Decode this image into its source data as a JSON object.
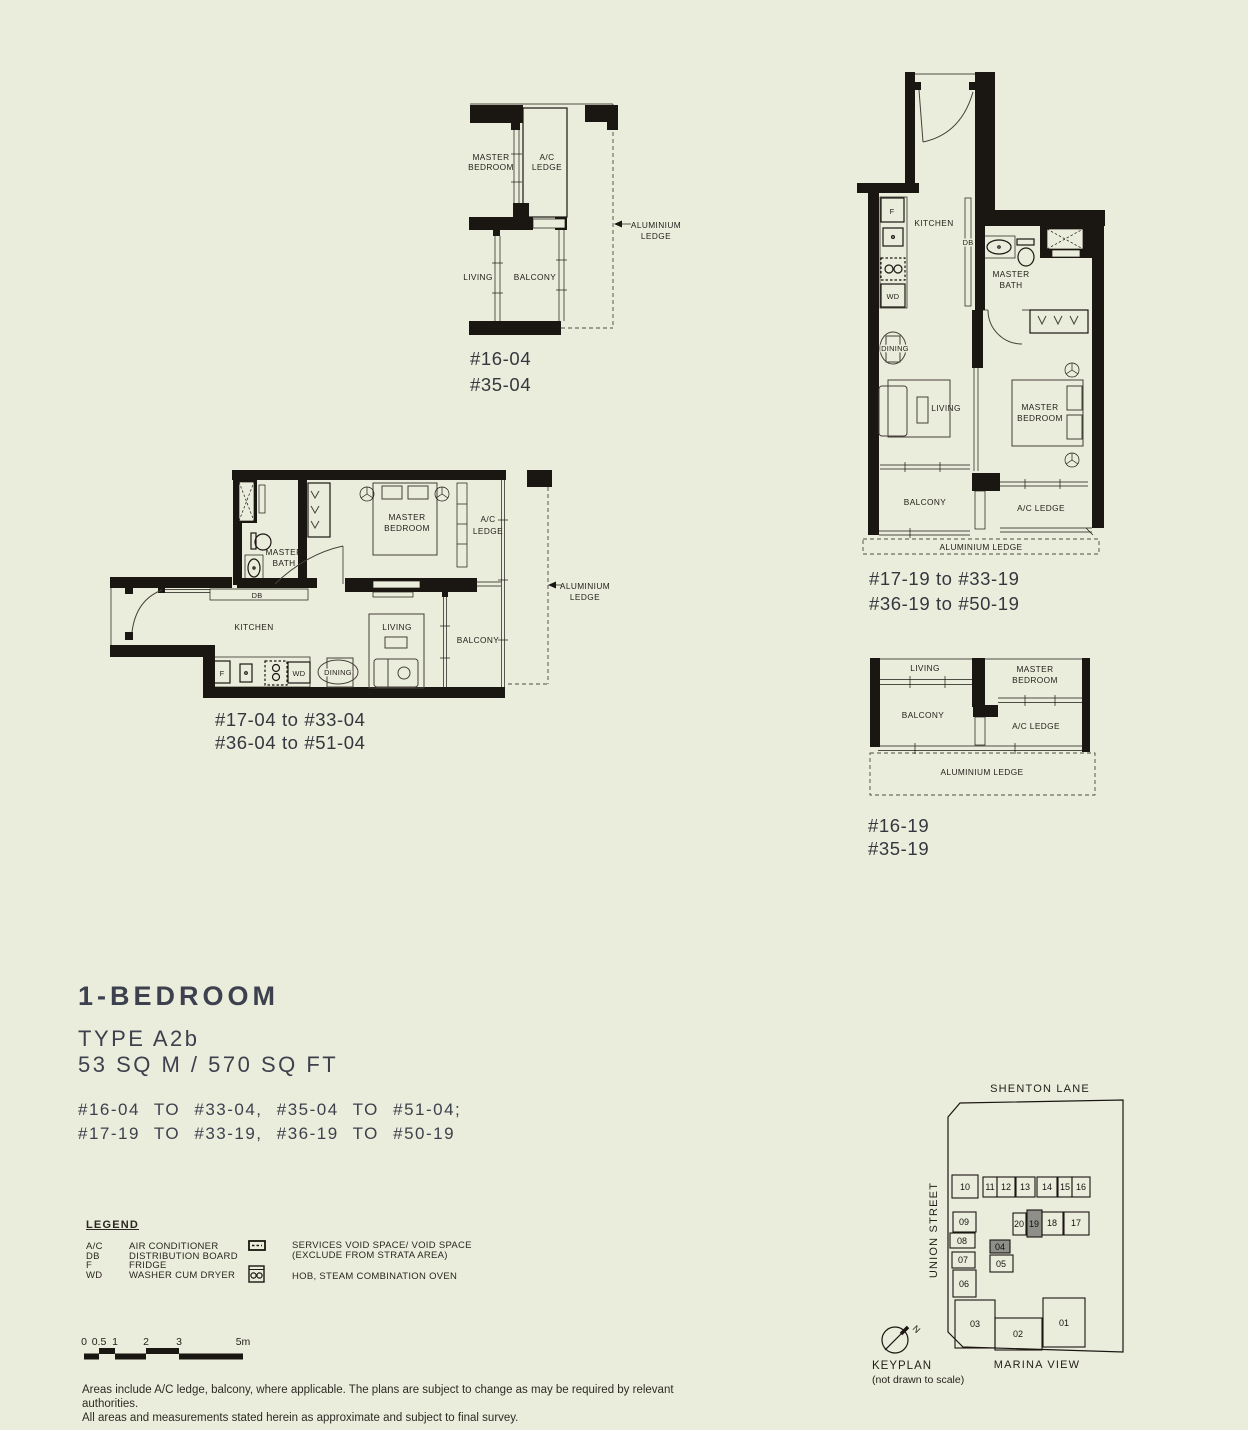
{
  "page": {
    "background": "#ebeddc",
    "ink": "#1a1611",
    "accent_text": "#3d414e"
  },
  "rooms": {
    "master": "MASTER",
    "bedroom": "BEDROOM",
    "bath": "BATH",
    "ac": "A/C",
    "ledge": "LEDGE",
    "ac_ledge": "A/C LEDGE",
    "living": "LIVING",
    "balcony": "BALCONY",
    "kitchen": "KITCHEN",
    "dining": "DINING",
    "db": "DB",
    "f": "F",
    "wd": "WD",
    "aluminium": "ALUMINIUM",
    "aluminium_ledge": "ALUMINIUM LEDGE"
  },
  "plans": {
    "top_left": {
      "units1": "#16-04",
      "units2": "#35-04"
    },
    "top_right": {
      "units1": "#17-19 to #33-19",
      "units2": "#36-19 to #50-19"
    },
    "mid_left": {
      "units1": "#17-04 to #33-04",
      "units2": "#36-04 to #51-04"
    },
    "right_partial": {
      "units1": "#16-19",
      "units2": "#35-19"
    }
  },
  "title": {
    "heading": "1-BEDROOM",
    "type_label": "TYPE A2b",
    "area_label": "53 SQ M / 570 SQ FT",
    "units_line1": "#16-04 TO #33-04, #35-04 TO #51-04;",
    "units_line2": "#17-19 TO #33-19, #36-19 TO #50-19"
  },
  "legend": {
    "heading": "LEGEND",
    "items": [
      {
        "abbr": "A/C",
        "label": "AIR CONDITIONER"
      },
      {
        "abbr": "DB",
        "label": "DISTRIBUTION BOARD"
      },
      {
        "abbr": "F",
        "label": "FRIDGE"
      },
      {
        "abbr": "WD",
        "label": "WASHER CUM DRYER"
      }
    ],
    "void_label1": "SERVICES VOID SPACE/ VOID SPACE",
    "void_label2": "(EXCLUDE FROM STRATA AREA)",
    "hob_label": "HOB, STEAM COMBINATION OVEN"
  },
  "scalebar": {
    "ticks": [
      "0",
      "0.5",
      "1",
      "2",
      "3",
      "5m"
    ]
  },
  "disclaimer": {
    "line1": "Areas include A/C ledge, balcony, where applicable. The plans are subject to change as may be required by relevant authorities.",
    "line2": "All areas and measurements stated herein as approximate and subject to final survey."
  },
  "keyplan": {
    "streets": {
      "top": "SHENTON LANE",
      "left": "UNION STREET",
      "bottom": "MARINA VIEW"
    },
    "label": "KEYPLAN",
    "sublabel": "(not drawn to scale)",
    "north_label": "N",
    "highlighted_units": [
      "04",
      "19"
    ],
    "units": {
      "u01": "01",
      "u02": "02",
      "u03": "03",
      "u04": "04",
      "u05": "05",
      "u06": "06",
      "u07": "07",
      "u08": "08",
      "u09": "09",
      "u10": "10",
      "u11": "11",
      "u12": "12",
      "u13": "13",
      "u14": "14",
      "u15": "15",
      "u16": "16",
      "u17": "17",
      "u18": "18",
      "u19": "19",
      "u20": "20"
    }
  }
}
